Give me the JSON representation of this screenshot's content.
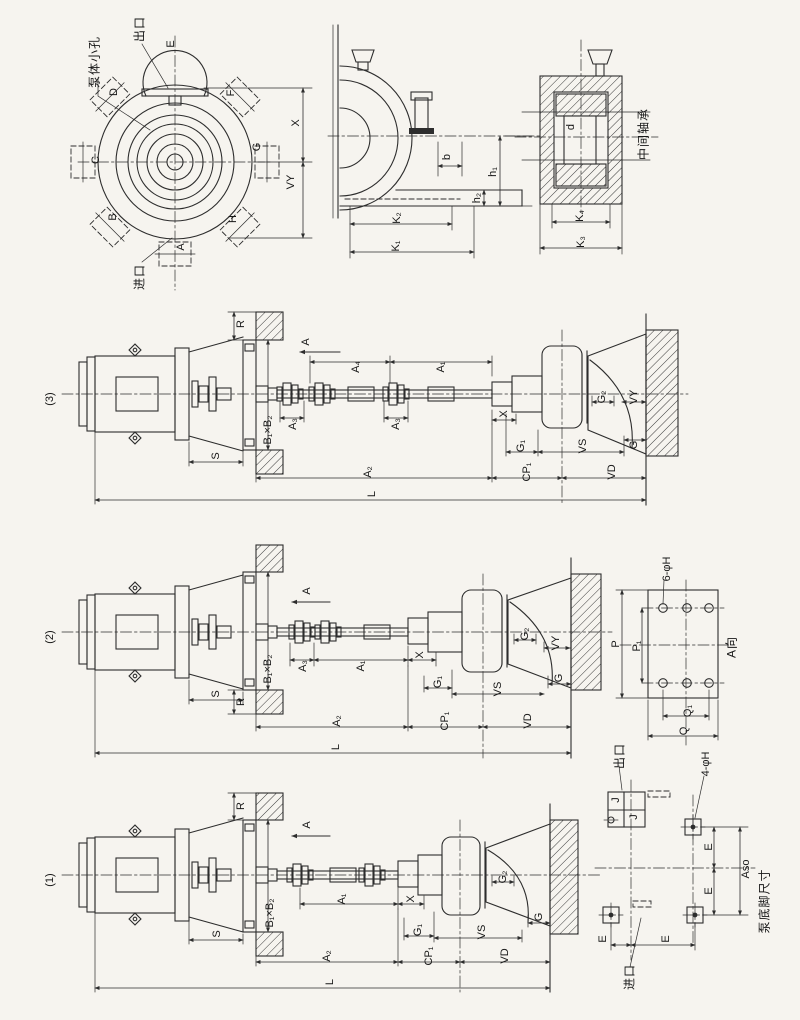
{
  "front_view": {
    "small_hole_note": "泵体小孔",
    "outlet_label": "出口",
    "inlet_label": "进口",
    "ports": {
      "a": "A",
      "b": "B",
      "c": "C",
      "d": "D",
      "e": "E",
      "f": "F",
      "g": "G",
      "h": "H"
    },
    "dim_x": "X",
    "dim_vy": "VY"
  },
  "side_view": {
    "dim_b": "b",
    "dim_h1": "h₁",
    "dim_h2": "h₂",
    "dim_k1": "K₁",
    "dim_k2": "K₂"
  },
  "bearing_view": {
    "title": "中间轴承",
    "dim_d": "d",
    "dim_k3": "K₃",
    "dim_k4": "K₄"
  },
  "sections": {
    "s3": {
      "id": "(3)",
      "r": "R",
      "a": "A",
      "a1": "A₁",
      "a2": "A₂",
      "a3a": "A₃",
      "a3b": "A₃",
      "a4": "A₄",
      "b1b2": "B₁×B₂",
      "s": "S",
      "l": "L",
      "x": "X",
      "g": "G",
      "g1": "G₁",
      "g2": "G₂",
      "vy": "VY",
      "vs": "VS",
      "vd": "VD",
      "cp1": "CP₁"
    },
    "s2": {
      "id": "(2)",
      "r": "R",
      "a": "A",
      "a1": "A₁",
      "a2": "A₂",
      "a3": "A₃",
      "b1b2": "B₁×B₂",
      "s": "S",
      "l": "L",
      "x": "X",
      "g": "G",
      "g1": "G₁",
      "g2": "G₂",
      "vy": "VY",
      "vs": "VS",
      "vd": "VD",
      "cp1": "CP₁"
    },
    "s1": {
      "id": "(1)",
      "r": "R",
      "a": "A",
      "a1": "A₁",
      "a2": "A₂",
      "b1b2": "B₁×B₂",
      "s": "S",
      "l": "L",
      "x": "X",
      "g": "G",
      "g1": "G₁",
      "g2": "G₂",
      "vs": "VS",
      "vd": "VD",
      "cp1": "CP₁"
    }
  },
  "flange_view": {
    "title": "A向",
    "holes_note": "6-φH",
    "dim_p": "P",
    "dim_p1": "P₁",
    "dim_q": "Q",
    "dim_q1": "Q₁"
  },
  "base_view": {
    "title": "泵底脚尺寸",
    "holes_note": "4-φH",
    "outlet_label": "出口",
    "inlet_label": "进口",
    "dim_e": "E",
    "dim_aso": "Aso",
    "dim_j": "J",
    "dim_j1": "J"
  }
}
